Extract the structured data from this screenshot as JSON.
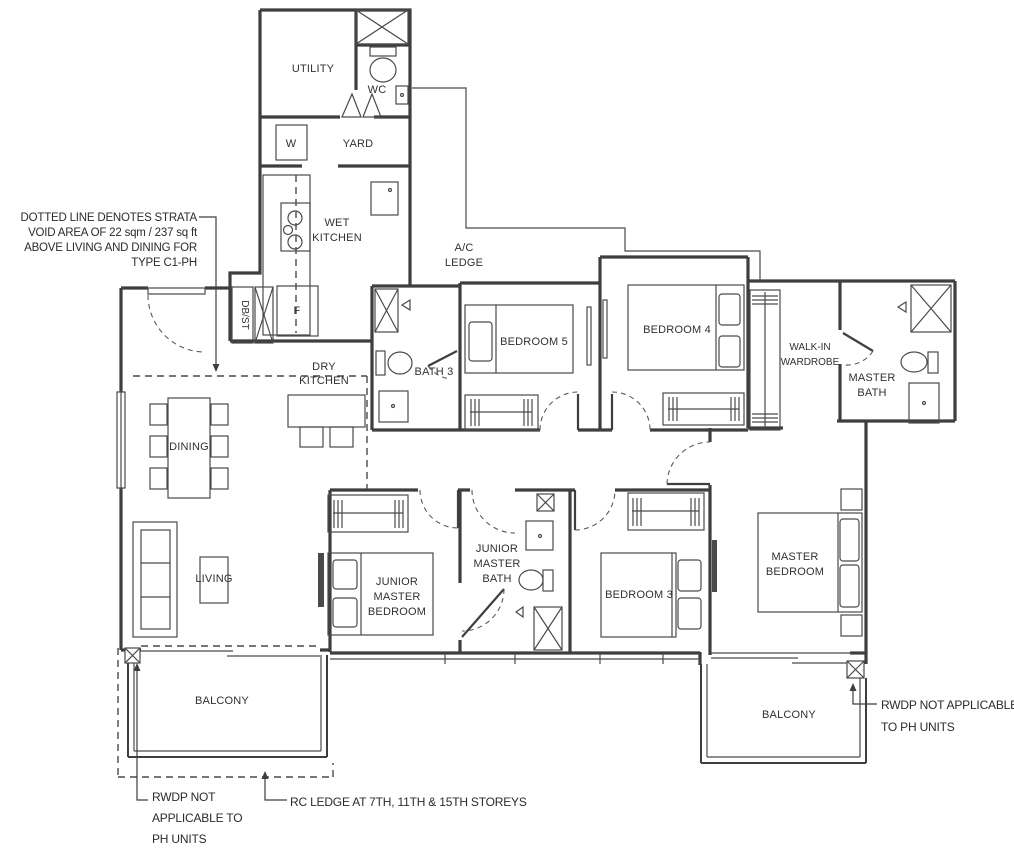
{
  "labels": {
    "utility": "UTILITY",
    "wc": "WC",
    "yard": "YARD",
    "washer": "W",
    "wet_kitchen_1": "WET",
    "wet_kitchen_2": "KITCHEN",
    "fridge": "F",
    "dbst": "DB/ST",
    "ac_ledge_1": "A/C",
    "ac_ledge_2": "LEDGE",
    "dry_kitchen_1": "DRY",
    "dry_kitchen_2": "KITCHEN",
    "bath3": "BATH 3",
    "bedroom5": "BEDROOM 5",
    "bedroom4": "BEDROOM 4",
    "walk_in_1": "WALK-IN",
    "walk_in_2": "WARDROBE",
    "master_bath_1": "MASTER",
    "master_bath_2": "BATH",
    "dining": "DINING",
    "living": "LIVING",
    "junior_master_bedroom_1": "JUNIOR",
    "junior_master_bedroom_2": "MASTER",
    "junior_master_bedroom_3": "BEDROOM",
    "junior_master_bath_1": "JUNIOR",
    "junior_master_bath_2": "MASTER",
    "junior_master_bath_3": "BATH",
    "bedroom3": "BEDROOM 3",
    "master_bedroom_1": "MASTER",
    "master_bedroom_2": "BEDROOM",
    "balcony_left": "BALCONY",
    "balcony_right": "BALCONY"
  },
  "annotations": {
    "strata_1": "DOTTED LINE DENOTES STRATA",
    "strata_2": "VOID AREA OF 22 sqm / 237 sq ft",
    "strata_3": "ABOVE LIVING AND DINING FOR",
    "strata_4": "TYPE C1-PH",
    "rwdp_left_1": "RWDP NOT",
    "rwdp_left_2": "APPLICABLE TO",
    "rwdp_left_3": "PH UNITS",
    "rc_ledge": "RC LEDGE AT 7TH, 11TH & 15TH STOREYS",
    "rwdp_right_1": "RWDP NOT APPLICABLE",
    "rwdp_right_2": "TO PH UNITS"
  },
  "colors": {
    "line": "#3e3e3e",
    "text": "#2b2b2b",
    "background": "#ffffff"
  }
}
